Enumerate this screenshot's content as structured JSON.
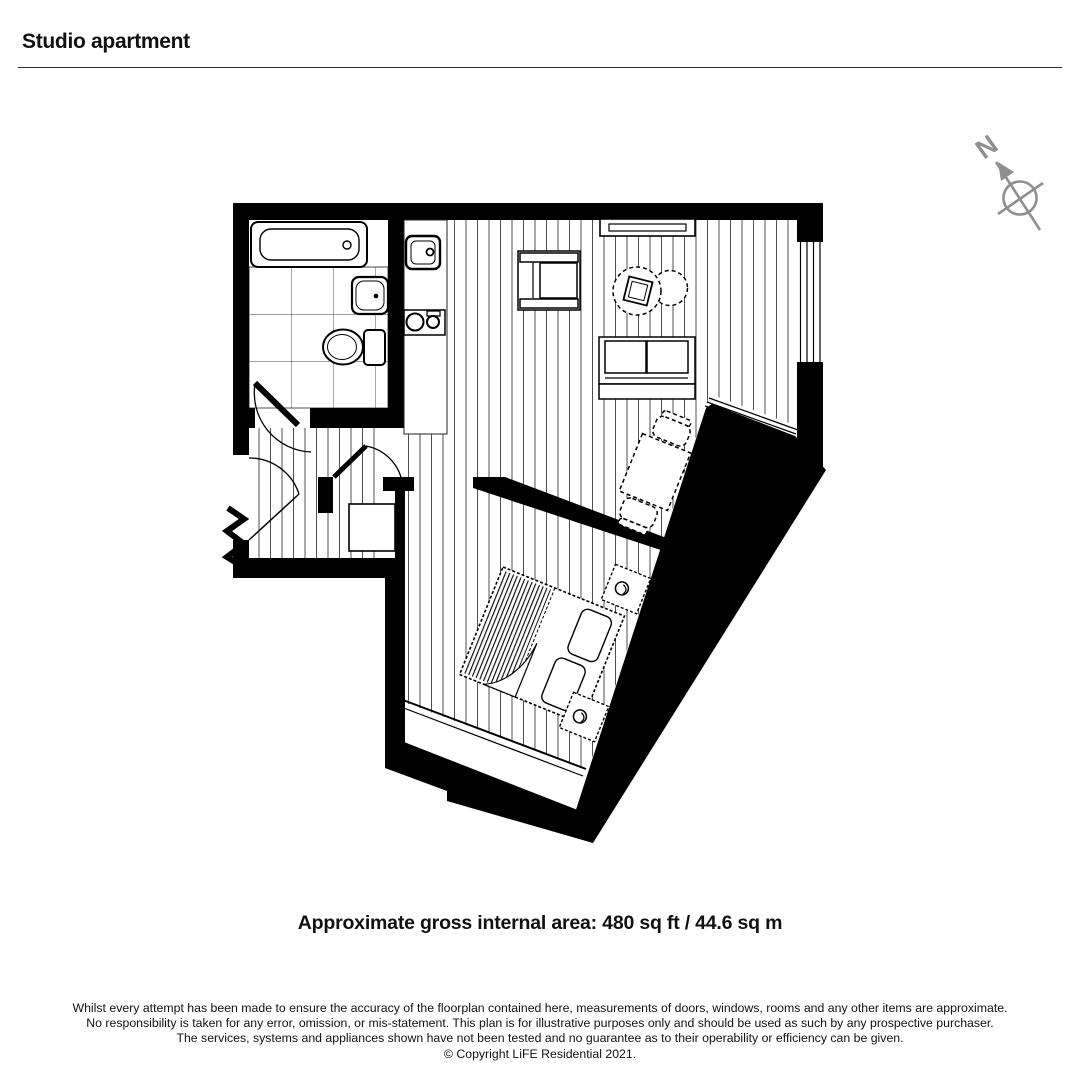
{
  "header": {
    "title": "Studio apartment"
  },
  "compass": {
    "label": "N"
  },
  "plan": {
    "ink_color": "#000000",
    "floor_line_color": "#3c3c3c",
    "compass_color": "#8f8f8f"
  },
  "footer": {
    "area_text": "Approximate gross internal area: 480 sq ft / 44.6 sq m",
    "disclaimer_lines": [
      "Whilst every attempt has been made to ensure the accuracy of the floorplan contained here, measurements of doors, windows, rooms and any other items are approximate.",
      "No responsibility is taken for any error, omission, or mis-statement. This plan is for illustrative purposes only and should be used as such by any prospective purchaser.",
      "The services, systems and appliances shown have not been tested and no guarantee as to their operability or efficiency can be given."
    ],
    "copyright": "© Copyright LiFE Residential 2021."
  }
}
